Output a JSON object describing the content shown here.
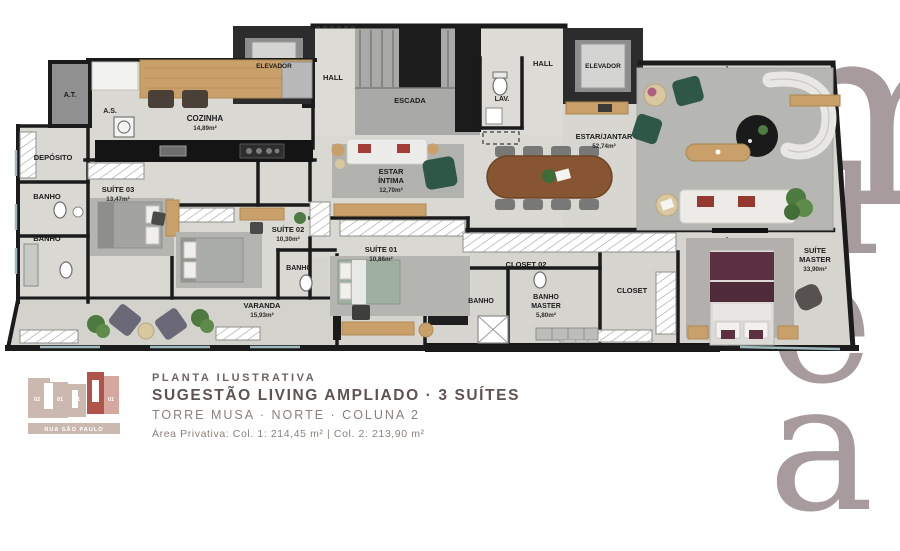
{
  "watermark": {
    "top": "am",
    "bottom_letters": [
      "u",
      "e",
      "a"
    ],
    "color": "#a79b9d"
  },
  "plan": {
    "rooms": [
      {
        "id": "at",
        "label": "A.T."
      },
      {
        "id": "as",
        "label": "A.S."
      },
      {
        "id": "cozinha",
        "label": "COZINHA",
        "area": "14,89m²"
      },
      {
        "id": "elevador-1",
        "label": "ELEVADOR"
      },
      {
        "id": "hall-1",
        "label": "HALL"
      },
      {
        "id": "escada",
        "label": "ESCADA"
      },
      {
        "id": "lav",
        "label": "LAV."
      },
      {
        "id": "hall-2",
        "label": "HALL"
      },
      {
        "id": "elevador-2",
        "label": "ELEVADOR"
      },
      {
        "id": "estar-jantar",
        "label": "ESTAR/JANTAR",
        "area": "52,74m²"
      },
      {
        "id": "deposito",
        "label": "DEPÓSITO"
      },
      {
        "id": "banho-1",
        "label": "BANHO"
      },
      {
        "id": "banho-2",
        "label": "BANHO"
      },
      {
        "id": "suite-03",
        "label": "SUÍTE 03",
        "area": "13,47m²"
      },
      {
        "id": "suite-02",
        "label": "SUÍTE 02",
        "area": "10,30m²"
      },
      {
        "id": "banho-suite-02",
        "label": "BANHO"
      },
      {
        "id": "suite-01",
        "label": "SUÍTE 01",
        "area": "10,86m²"
      },
      {
        "id": "estar-intima",
        "label_line1": "ESTAR",
        "label_line2": "ÍNTIMA",
        "area": "12,70m²"
      },
      {
        "id": "closet-02",
        "label": "CLOSET 02"
      },
      {
        "id": "banho-suite-01",
        "label": "BANHO"
      },
      {
        "id": "banho-master",
        "label_line1": "BANHO",
        "label_line2": "MASTER",
        "area": "5,80m²"
      },
      {
        "id": "closet",
        "label": "CLOSET"
      },
      {
        "id": "suite-master",
        "label_line1": "SUÍTE",
        "label_line2": "MASTER",
        "area": "33,90m²"
      },
      {
        "id": "varanda",
        "label": "VARANDA",
        "area": "15,93m²"
      }
    ]
  },
  "key_plan": {
    "street": "RUA SÃO PAULO",
    "units": [
      "02",
      "01",
      "01",
      "02",
      "01"
    ],
    "base_color": "#cbb9b0",
    "highlight_color": "#ae544b",
    "adjacent_color": "#d5a79e"
  },
  "caption": {
    "line1": "PLANTA ILUSTRATIVA",
    "line2": "SUGESTÃO LIVING AMPLIADO · 3 SUÍTES",
    "line3": "TORRE MUSA · NORTE · COLUNA 2",
    "line4": "Área Privativa: Col. 1: 214,45 m² | Col. 2: 213,90 m²"
  },
  "colors": {
    "wall": "#1b1b1b",
    "floor": "#d9d8d3",
    "wood": "#c9a06a",
    "dining_wood": "#875531",
    "rug": "#b4b4b0",
    "green_chair": "#2e5747",
    "red_cushion": "#a23e36",
    "master_bed": "#5c3040",
    "varanda_chair": "#6b6878"
  }
}
